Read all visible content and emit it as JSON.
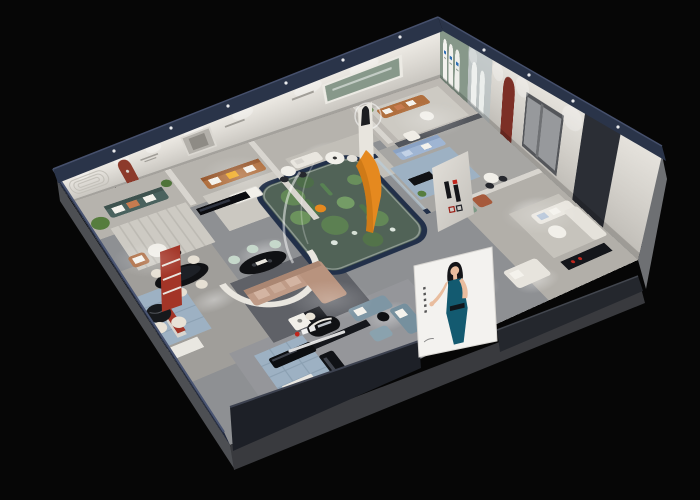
{
  "scene": {
    "kind": "3d-dollhouse-cutaway-render-of-furniture-showroom",
    "background": "#060606",
    "camera": "high-angle-perspective"
  },
  "brand": {
    "name": "华凯",
    "logo_mark": "H",
    "logo_red": "#c0261d",
    "logo_dark": "#141519",
    "locations": [
      "interior partition wall",
      "storefront fascia sign"
    ]
  },
  "poster": {
    "description": "woman in teal halter dress on white billboard",
    "bg": "#f3f2ef",
    "dress": "#135a70",
    "skin": "#e9bd9e",
    "hair": "#141518",
    "side_glyph_count": 5
  },
  "signage": {
    "arch_lightbox_count": 3,
    "arch_logo_blue": "#2f6fb4",
    "storefront_underline": "#f2f2f2"
  },
  "rooms": [
    {
      "id": "teal-lounge",
      "feature": "racetrack groove wall, dark teal sofa"
    },
    {
      "id": "caramel-lounge",
      "feature": "red arched niche, caramel leather sofa"
    },
    {
      "id": "gallery-aisle",
      "feature": "statue pedestal, halo lamp, orange slide sculpture"
    },
    {
      "id": "green-arch-room",
      "feature": "sage wall with three white arched lightboxes"
    },
    {
      "id": "glass-room",
      "feature": "periwinkle sofa behind glass partitions"
    },
    {
      "id": "white-suite",
      "feature": "white sofas, red arch, media console"
    },
    {
      "id": "atrium",
      "feature": "glass garden with cacti"
    },
    {
      "id": "dining-corner",
      "feature": "black oval table, cream chairs, red display shelf"
    },
    {
      "id": "reception",
      "feature": "round black counter, brand sign, glossy benches"
    },
    {
      "id": "front-lounge",
      "feature": "blue-grey modular sofas and ottoman"
    }
  ],
  "palette": {
    "bg": "#060606",
    "roof_navy": "#2a3449",
    "roof_navy_hi": "#46506c",
    "wall_face": "#e7e4de",
    "wall_face_shade": "#c9c6c0",
    "left_wall": "#232b3f",
    "right_outer": "#6e7073",
    "slab": "#393a3e",
    "fascia": "#1d2027",
    "fascia2": "#24272d",
    "floor_aisle": "#8e9093",
    "floor_room": "#b6b3ad",
    "rug_light": "#cdcac3",
    "rug_dark": "#5f6167",
    "rug_blue": "#9db1c3",
    "atrium_ground": "#41503e",
    "atrium_frame": "#223049",
    "plant": "#567d3e",
    "plant_dark": "#3c5c2e",
    "sofa_teal": "#4a625e",
    "sofa_caramel": "#b06f3e",
    "sofa_mauve": "#bf9b87",
    "sofa_periwinkle": "#9fb5d3",
    "sofa_sage": "#7e9a86",
    "sofa_bluegrey": "#7e96a4",
    "sofa_white": "#e9e6df",
    "chair_rust": "#a65a3c",
    "chair_cream": "#e6e0d4",
    "mint": "#c6d8cb",
    "pillow_orange": "#e5891f",
    "pillow_yellow": "#f0a81c",
    "pillow_white": "#f4f2ec",
    "pillow_blue": "#aebfd4",
    "table_black": "#101114",
    "table_white": "#f1efe9",
    "accent_red": "#8c3a2b",
    "accent_red_deep": "#7c2f26",
    "green_wall": "#87988a",
    "dark_partition": "#53565c",
    "sign_white": "#f2f2f2"
  }
}
